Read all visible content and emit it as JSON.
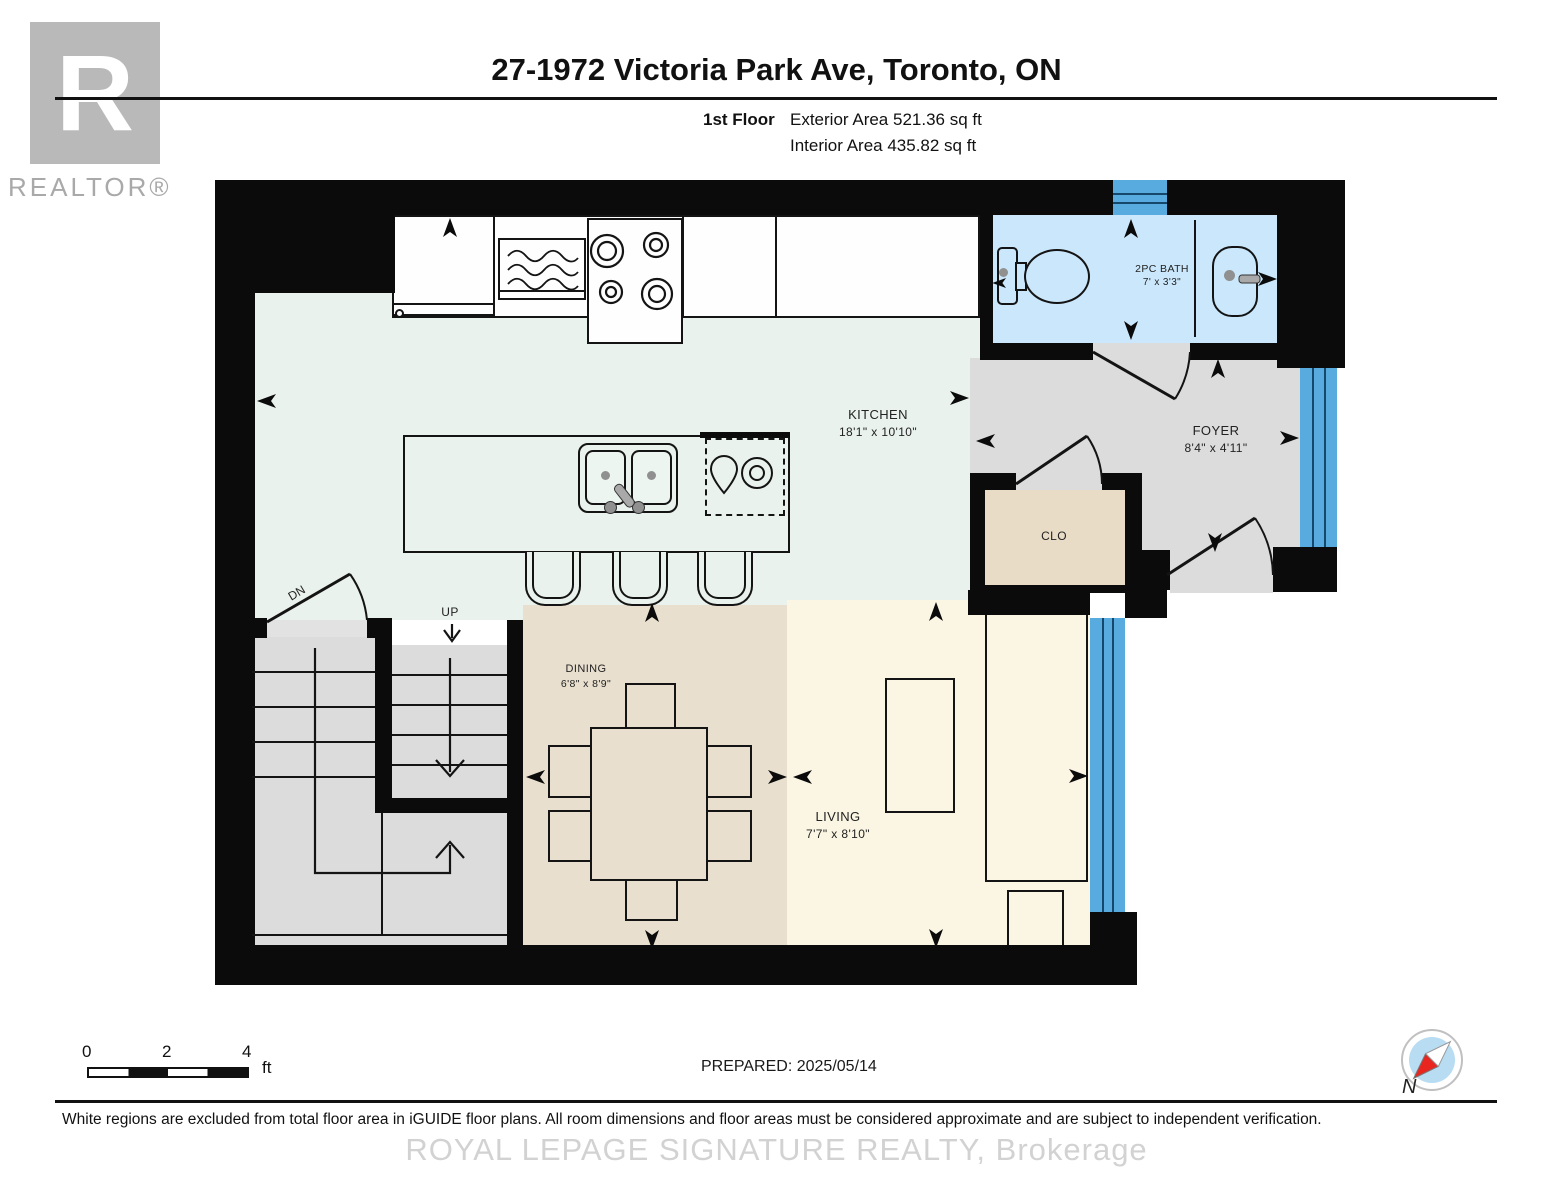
{
  "header": {
    "title": "27-1972 Victoria Park Ave, Toronto, ON",
    "floor_label": "1st Floor",
    "exterior_area": "Exterior Area 521.36 sq ft",
    "interior_area": "Interior Area 435.82 sq ft",
    "logo_r": "R",
    "realtor_label": "REALTOR®"
  },
  "rooms": {
    "kitchen": {
      "name": "KITCHEN",
      "dims": "18'1\" x 10'10\""
    },
    "bath": {
      "name": "2PC BATH",
      "dims": "7' x 3'3\""
    },
    "foyer": {
      "name": "FOYER",
      "dims": "8'4\" x 4'11\""
    },
    "closet": {
      "name": "CLO"
    },
    "dining": {
      "name": "DINING",
      "dims": "6'8\" x 8'9\""
    },
    "living": {
      "name": "LIVING",
      "dims": "7'7\" x 8'10\""
    }
  },
  "stairs": {
    "up": "UP",
    "down": "DN"
  },
  "scale_bar": {
    "t0": "0",
    "t2": "2",
    "t4": "4",
    "unit": "ft"
  },
  "footer": {
    "prepared": "PREPARED: 2025/05/14",
    "disclaimer": "White regions are excluded from total floor area in iGUIDE floor plans. All room dimensions and floor areas must be considered approximate and are subject to independent verification.",
    "watermark": "ROYAL LEPAGE SIGNATURE REALTY, Brokerage",
    "compass_n": "N"
  },
  "colors": {
    "wall": "#0b0b0b",
    "kitchen_floor": "#e9f2ec",
    "bath_floor": "#cbe7fb",
    "gray_floor": "#dcdcdc",
    "closet_floor": "#e9dcc6",
    "dining_floor": "#e8dfce",
    "living_floor": "#fbf6e3",
    "window_blue": "#57abdf",
    "logo_gray": "#b9b9b9"
  }
}
